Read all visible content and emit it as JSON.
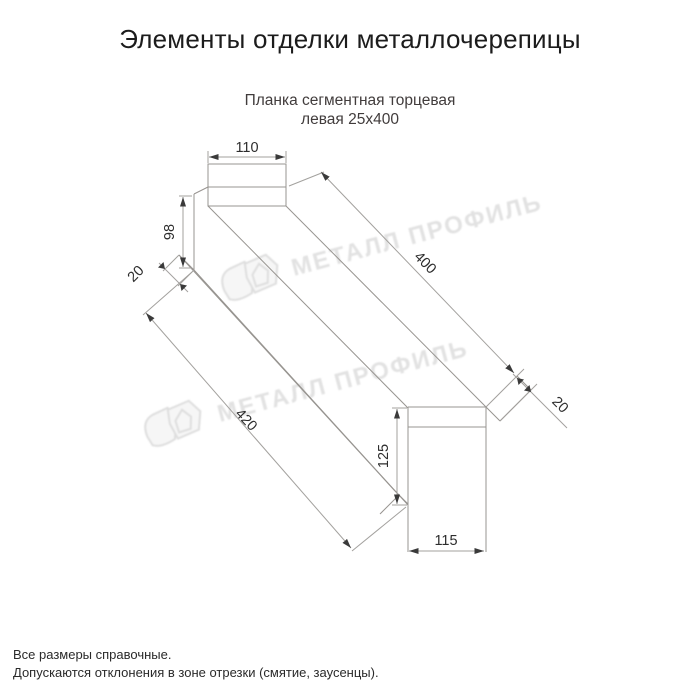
{
  "page": {
    "title": "Элементы отделки металлочерепицы"
  },
  "drawing": {
    "subtitle_line1": "Планка сегментная торцевая",
    "subtitle_line2": "левая 25х400",
    "dimensions": {
      "top_face_width": "110",
      "left_end_height": "98",
      "left_hem": "20",
      "top_edge_length": "400",
      "bottom_edge_length": "420",
      "right_hem": "20",
      "right_end_height": "125",
      "right_end_width": "115"
    }
  },
  "watermark": {
    "text": "МЕТАЛЛ ПРОФИЛЬ"
  },
  "footer": {
    "line1": "Все размеры справочные.",
    "line2": "Допускаются отклонения в зоне отрезки (смятие, заусенцы)."
  },
  "colors": {
    "edge_line": "#979490",
    "dim_line": "#a3a19e",
    "dim_text": "#2d2d2d",
    "watermark": "#e2e2e2",
    "title": "#1c1c1c",
    "subtitle": "#413c3c"
  }
}
